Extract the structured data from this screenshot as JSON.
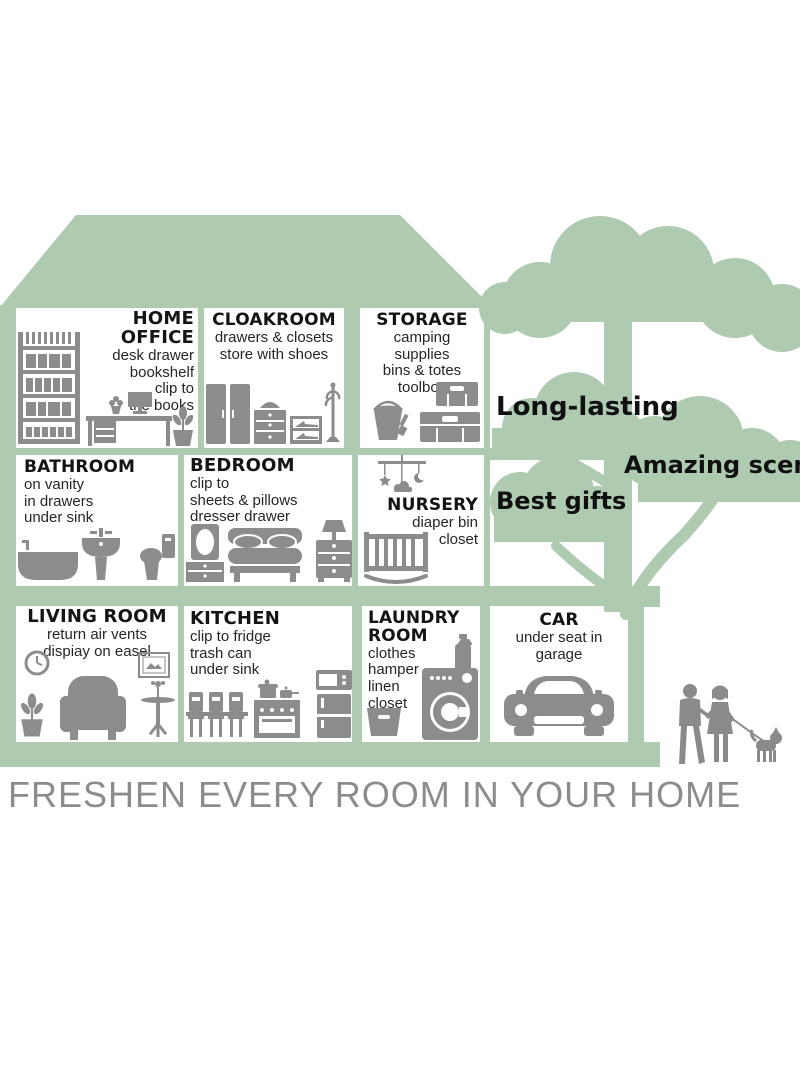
{
  "banner": {
    "text": "FRESHEN EVERY ROOM IN YOUR HOME"
  },
  "labels": {
    "long_lasting": "Long-lasting",
    "amazing_scent": "Amazing scent",
    "best_gifts": "Best gifts"
  },
  "colors": {
    "house_green": "#aecab0",
    "icon_gray": "#8c8c8c",
    "banner_gray": "#8c8c8c",
    "text_black": "#141414"
  },
  "rooms": [
    {
      "name": "home-office",
      "title": "HOME OFFICE",
      "lines": [
        "desk drawer",
        "bookshelf",
        "clip to",
        "the books"
      ],
      "icons": [
        "bookshelf",
        "desk-with-computer",
        "potted-plant"
      ]
    },
    {
      "name": "cloakroom",
      "title": "CLOAKROOM",
      "lines": [
        "drawers & closets",
        "store with shoes"
      ],
      "icons": [
        "wardrobe",
        "chest-of-drawers",
        "shoe-cabinet",
        "coat-rack"
      ]
    },
    {
      "name": "storage",
      "title": "STORAGE",
      "lines": [
        "camping",
        "supplies",
        "bins & totes",
        "toolbox"
      ],
      "icons": [
        "bucket-and-brush",
        "stacked-toolboxes"
      ]
    },
    {
      "name": "bathroom",
      "title": "BATHROOM",
      "lines": [
        "on vanity",
        "in drawers",
        "under sink"
      ],
      "icons": [
        "bathtub",
        "pedestal-sink",
        "toilet"
      ]
    },
    {
      "name": "bedroom",
      "title": "BEDROOM",
      "lines": [
        "clip to",
        "sheets & pillows",
        "dresser drawer"
      ],
      "icons": [
        "mirror-dresser",
        "bed",
        "nightstand-with-lamp"
      ]
    },
    {
      "name": "nursery",
      "title": "NURSERY",
      "lines": [
        "diaper bin",
        "closet"
      ],
      "icons": [
        "baby-mobile",
        "rocking-crib"
      ]
    },
    {
      "name": "living-room",
      "title": "LIVING ROOM",
      "lines": [
        "return air vents",
        "dispiay on easel"
      ],
      "icons": [
        "wall-clock",
        "picture-frame",
        "potted-plant",
        "armchair",
        "side-table"
      ]
    },
    {
      "name": "kitchen",
      "title": "KITCHEN",
      "lines": [
        "clip to fridge",
        "trash can",
        "under sink"
      ],
      "icons": [
        "dining-set",
        "stove-with-pots",
        "fridge-with-microwave"
      ]
    },
    {
      "name": "laundry-room",
      "title": "LAUNDRY ROOM",
      "lines": [
        "clothes",
        "hamper",
        "linen",
        "closet"
      ],
      "icons": [
        "detergent-bottle",
        "laundry-basket",
        "washing-machine"
      ]
    },
    {
      "name": "car",
      "title": "CAR",
      "lines": [
        "under seat in",
        "garage"
      ],
      "icons": [
        "car-front"
      ]
    }
  ]
}
